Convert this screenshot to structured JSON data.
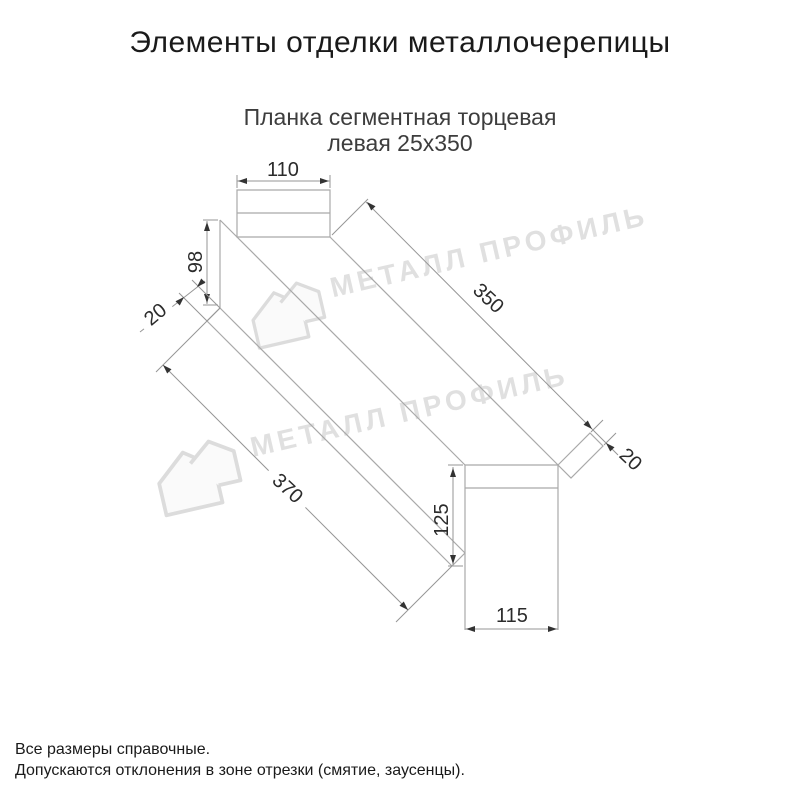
{
  "header": {
    "title": "Элементы отделки металлочерепицы",
    "subtitle_line1": "Планка сегментная торцевая",
    "subtitle_line2": "левая 25х350"
  },
  "drawing": {
    "type": "technical-diagram",
    "dimensions": {
      "top_width": "110",
      "end_height": "98",
      "left_hem": "20",
      "top_length": "350",
      "right_hem": "20",
      "bottom_length": "370",
      "right_cap_height": "125",
      "right_cap_width": "115"
    }
  },
  "watermark": {
    "brand": "МЕТАЛЛ ПРОФИЛЬ"
  },
  "footer": {
    "note1": "Все размеры справочные.",
    "note2": "Допускаются отклонения в зоне отрезки (смятие, заусенцы)."
  }
}
